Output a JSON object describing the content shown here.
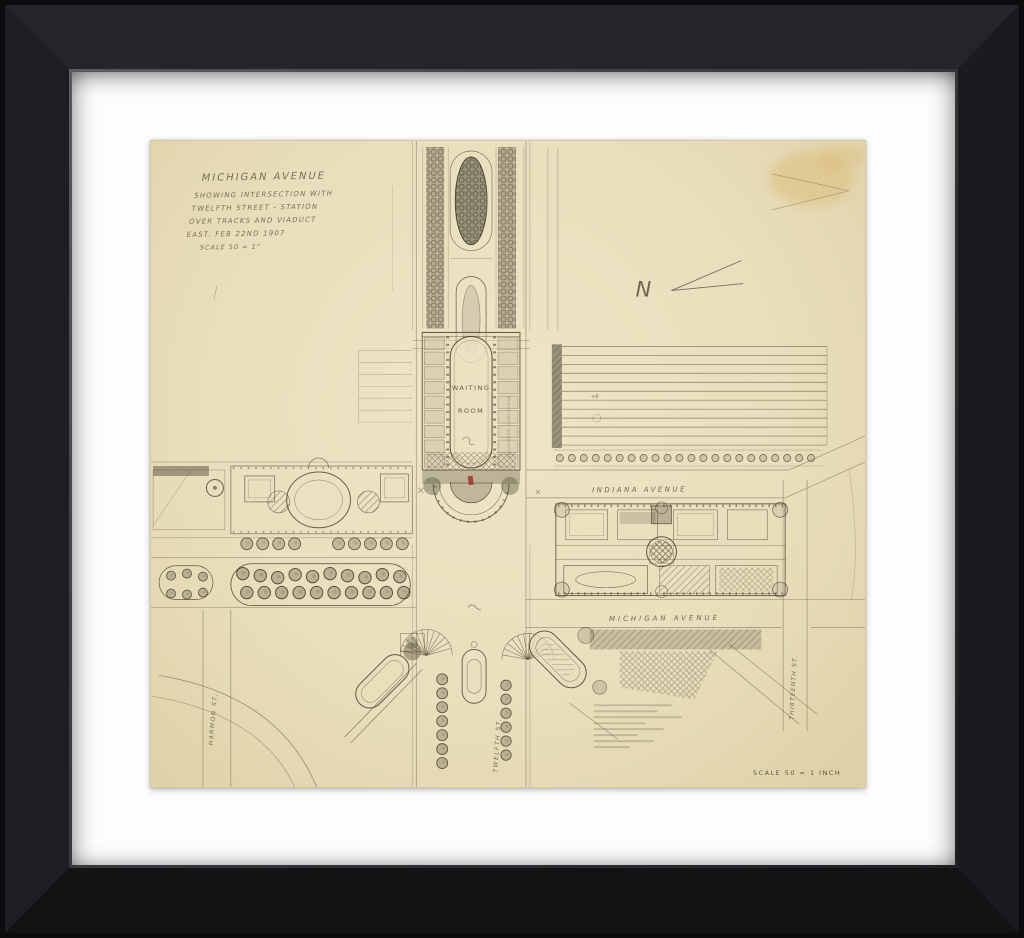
{
  "artwork": {
    "description": "Framed pencil plan drawing of a city intersection with railway station",
    "title_block": {
      "line1": "MICHIGAN AVENUE",
      "line2": "SHOWING INTERSECTION WITH",
      "line3": "TWELFTH STREET - STATION",
      "line4": "OVER TRACKS AND VIADUCT",
      "line5": "EAST.  FEB 22ND 1907",
      "line6": "SCALE 50 = 1\""
    },
    "labels": {
      "north_indicator": "N",
      "waiting_room_1": "WAITING",
      "waiting_room_2": "ROOM",
      "concourse": "PASSENGER CONCOURSE",
      "indiana_avenue": "INDIANA AVENUE",
      "michigan_avenue": "MICHIGAN AVENUE",
      "harmon_street": "HARMON ST.",
      "twelfth_street": "TWELFTH ST.",
      "thirteenth_street": "THIRTEENTH ST.",
      "elevation_note": "+6",
      "scale_note": "SCALE 50 = 1 INCH"
    },
    "colors": {
      "frame": "#141517",
      "mat": "#fdfdfc",
      "paper": "#e9dfbc",
      "pencil": "#564f3d",
      "stain": "#d8ab55",
      "accent_red": "#9e3526"
    }
  }
}
